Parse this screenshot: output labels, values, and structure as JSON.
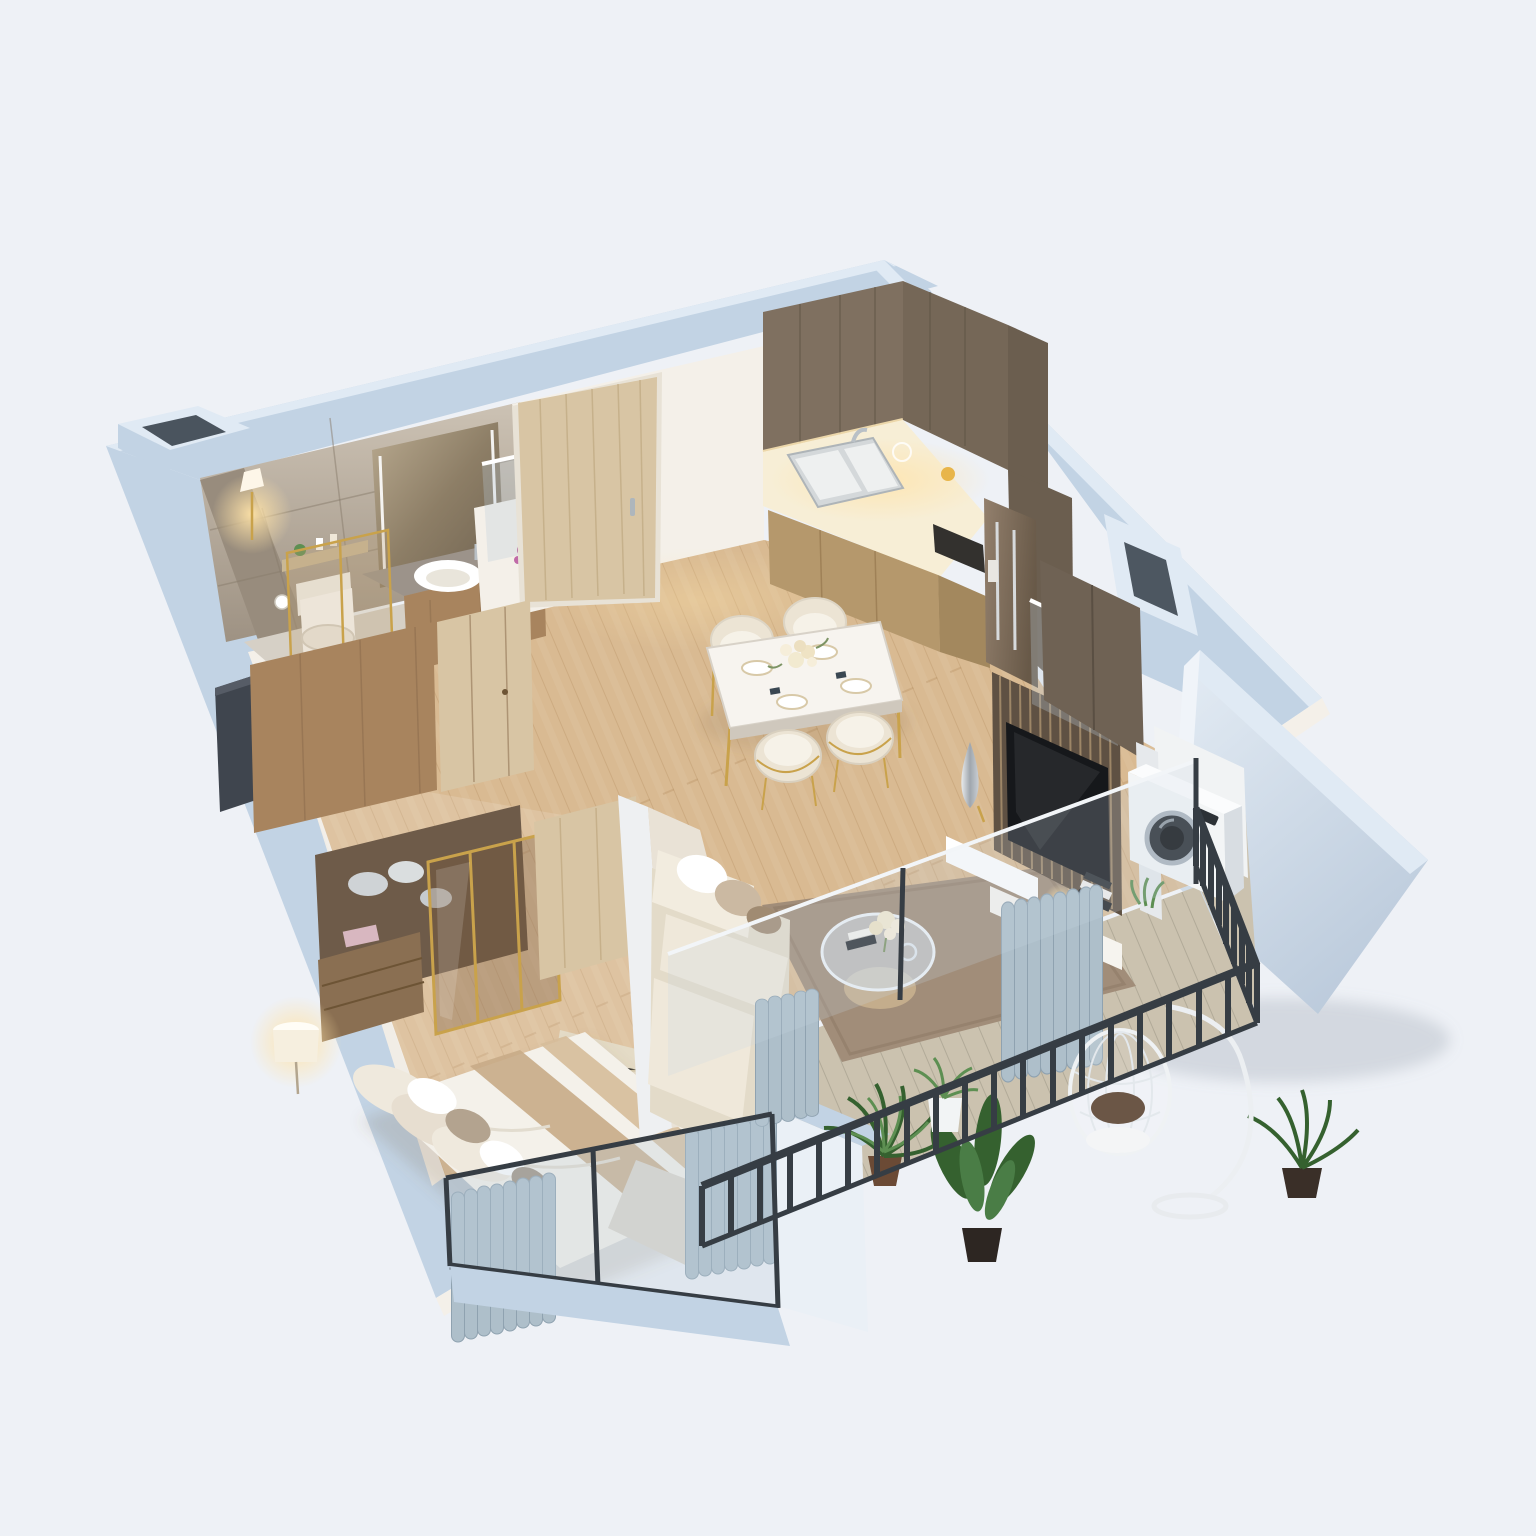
{
  "meta": {
    "title": "3D isometric cutaway floor plan of a one-bedroom apartment",
    "view": "top-down dollhouse render",
    "rooms_count": "7 zones"
  },
  "palette": {
    "bg": "#eef1f6",
    "wall_side": "#c2d3e4",
    "wall_top": "#e0eaf4",
    "wall_inner": "#f4f0e9",
    "marble_light": "#ccc2b4",
    "marble_dark": "#9e9283",
    "wood_floor": "#d9ba92",
    "plank_line": "#a97f4f",
    "balcony_floor": "#cbc2af",
    "cabinet_dark": "#7f7060",
    "cabinet_tan": "#b5986c",
    "wood_mid": "#a8845e",
    "wood_light": "#d8c5a4",
    "counter_glow": "#f7eed6",
    "gold": "#c9a24b",
    "fixture_white": "#ffffff",
    "sofa_cream": "#ece4d4",
    "rug_living": "#a18d79",
    "rug_bedroom": "#e4dbc6",
    "curtain": "#aebfca",
    "railing_dark": "#363d44",
    "glass_tint": "rgba(190,205,218,0.30)",
    "plant_dark": "#35612f",
    "plant_light": "#5d8f52",
    "fridge_bronze": "#82705f",
    "tv_dark": "#16181b",
    "flower_purple": "#a94f92",
    "flower_cream": "#f2ead0"
  },
  "rooms": [
    {
      "id": "bathroom",
      "name": "Bathroom",
      "items": [
        "marble tiled walls",
        "wall sconce lamp",
        "LED backlit mirror",
        "vessel sink vanity",
        "toilet",
        "toilet paper holder",
        "toiletries shelf",
        "gold-framed shower glass"
      ]
    },
    {
      "id": "entry",
      "name": "Entry hall",
      "items": [
        "entrance door (light oak)",
        "purple bouquet on pony wall",
        "glass half partition",
        "wood hallway wardrobe",
        "dark console cabinet"
      ]
    },
    {
      "id": "kitchen",
      "name": "Kitchen",
      "items": [
        "dark oak tall cabinets",
        "marble lit countertop",
        "double sink with faucet",
        "tan base cabinets",
        "cooktop",
        "built-in bronze fridge"
      ]
    },
    {
      "id": "dining",
      "name": "Dining area",
      "items": [
        "white marble dining table",
        "gold table legs",
        "4 cream chairs with gold trim",
        "table setting plates",
        "rose centerpiece"
      ]
    },
    {
      "id": "living",
      "name": "Living room",
      "items": [
        "L-shaped cream sofa",
        "accent pillows",
        "round glass coffee table",
        "flower vase",
        "brown rug",
        "slatted wood TV wall",
        "wall-mounted TV",
        "white media console",
        "silver teardrop vase",
        "book stack",
        "gold table lamp",
        "glass partition"
      ]
    },
    {
      "id": "bedroom",
      "name": "Bedroom",
      "items": [
        "double bed with beige runner",
        "pillow set",
        "throw blanket",
        "shag rug",
        "gold-framed glass wardrobe",
        "folded clothes",
        "drawer dresser",
        "floor lamp",
        "wall TV panel",
        "window curtains"
      ]
    },
    {
      "id": "balcony",
      "name": "Balcony",
      "items": [
        "black metal railing",
        "wood-tile deck",
        "palm plant",
        "banana plant",
        "white pot plant",
        "hanging egg chair",
        "washing machine",
        "privacy parapet"
      ]
    },
    {
      "id": "structure",
      "name": "Structure",
      "items": [
        "blue-gray exterior walls",
        "west duct shaft",
        "east duct shaft",
        "freestanding party wall",
        "glazed window walls"
      ]
    }
  ]
}
